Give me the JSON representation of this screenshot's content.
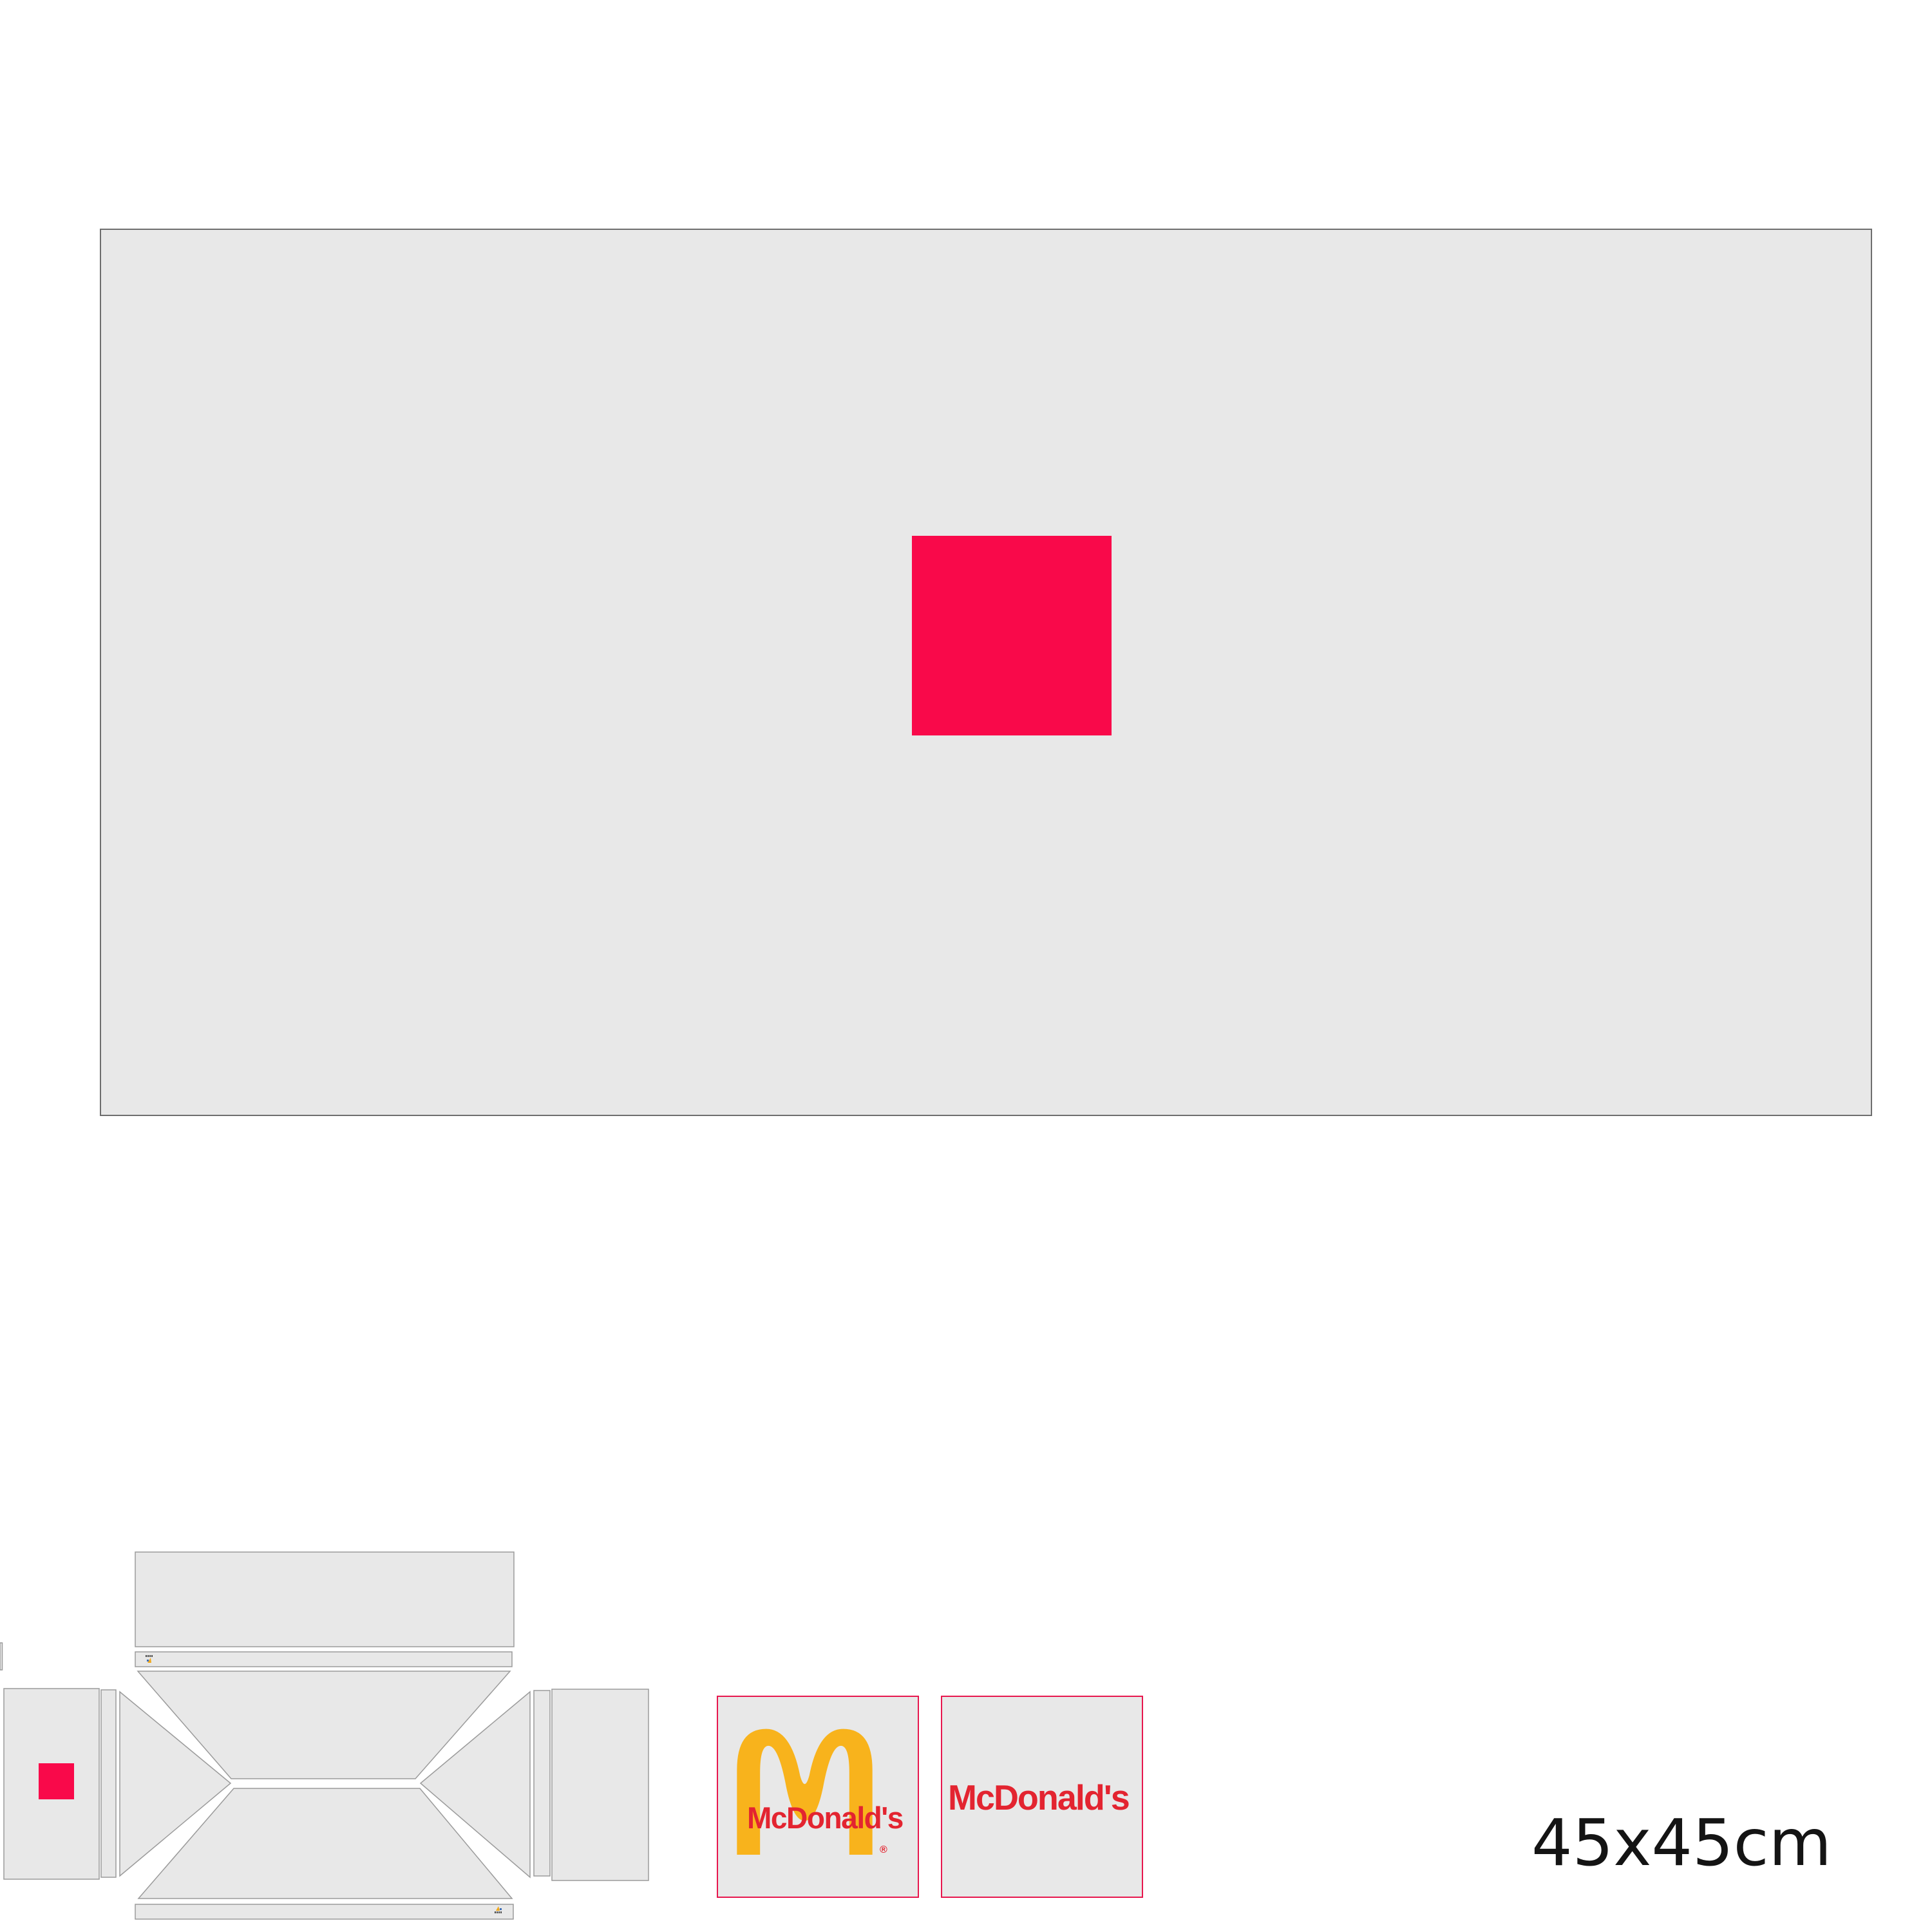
{
  "page": {
    "size_label": "45x45cm",
    "background": "#ffffff"
  },
  "palette": {
    "accent": "#f9094a",
    "panel_fill": "#e8e8e8",
    "panel_stroke": "#9b9b9b",
    "artboard_border": "#6e6e6e"
  },
  "artboard": {
    "description": "large gray artboard with centered accent square"
  },
  "dieline": {
    "description": "unfolded box packaging dieline with lid, glue strips, gusset flaps and end panels"
  },
  "brand": {
    "frame_color": "#e7174e",
    "arches_color": "#f8b31c",
    "wordmark_color": "#e32430",
    "logo_tile": {
      "wordmark": "McDonald's",
      "registered": "®"
    },
    "wordmark_tile": {
      "wordmark": "McDonald's"
    }
  },
  "print_mark": {
    "dark": "#4a4a4a",
    "yellow": "#f0a81c",
    "blue": "#3f6fb5"
  }
}
